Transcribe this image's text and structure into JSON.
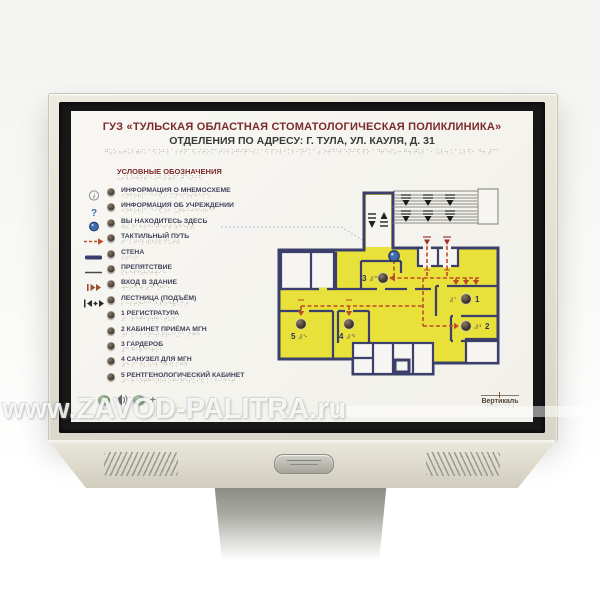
{
  "watermark_text": "www.ZAVOD-PALITRA.ru",
  "panel": {
    "title": "ГУЗ «ТУЛЬСКАЯ ОБЛАСТНАЯ СТОМАТОЛОГИЧЕСКАЯ ПОЛИКЛИНИКА»",
    "subtitle": "ОТДЕЛЕНИЯ ПО АДРЕСУ: Г. ТУЛА, УЛ. КАУЛЯ, Д. 31",
    "legend_header": "УСЛОВНЫЕ ОБОЗНАЧЕНИЯ",
    "legend_items": [
      {
        "icon": "info-icon",
        "label": "ИНФОРМАЦИЯ О МНЕМОСХЕМЕ"
      },
      {
        "icon": "question-icon",
        "label": "ИНФОРМАЦИЯ ОБ УЧРЕЖДЕНИИ"
      },
      {
        "icon": "you-are-here-icon",
        "label": "ВЫ НАХОДИТЕСЬ ЗДЕСЬ"
      },
      {
        "icon": "tactile-path-icon",
        "label": "ТАКТИЛЬНЫЙ ПУТЬ"
      },
      {
        "icon": "wall-icon",
        "label": "СТЕНА"
      },
      {
        "icon": "obstacle-icon",
        "label": "ПРЕПЯТСТВИЕ"
      },
      {
        "icon": "entrance-icon",
        "label": "ВХОД В ЗДАНИЕ"
      },
      {
        "icon": "stairs-icon",
        "label": "ЛЕСТНИЦА (ПОДЪЁМ)"
      },
      {
        "icon": "none",
        "label": "1 РЕГИСТРАТУРА"
      },
      {
        "icon": "none",
        "label": "2 КАБИНЕТ ПРИЁМА МГН"
      },
      {
        "icon": "none",
        "label": "3 ГАРДЕРОБ"
      },
      {
        "icon": "none",
        "label": "4 САНУЗЕЛ ДЛЯ МГН"
      },
      {
        "icon": "none",
        "label": "5 РЕНТГЕНОЛОГИЧЕСКИЙ КАБИНЕТ"
      }
    ],
    "volume": {
      "minus": "−",
      "plus": "+"
    },
    "logo": {
      "name": "Вертикаль"
    }
  },
  "floor_plan": {
    "rooms": [
      {
        "number": "1"
      },
      {
        "number": "2"
      },
      {
        "number": "3"
      },
      {
        "number": "4"
      },
      {
        "number": "5"
      }
    ]
  },
  "colors": {
    "title_maroon": "#7b2b2b",
    "wall_navy": "#3c3f6b",
    "room_yellow": "#e7e13a",
    "path_red": "#bf4b28",
    "here_blue": "#3e6cb0",
    "frame_beige": "#e3e1d4",
    "braille_gray": "#b3ab9c"
  }
}
